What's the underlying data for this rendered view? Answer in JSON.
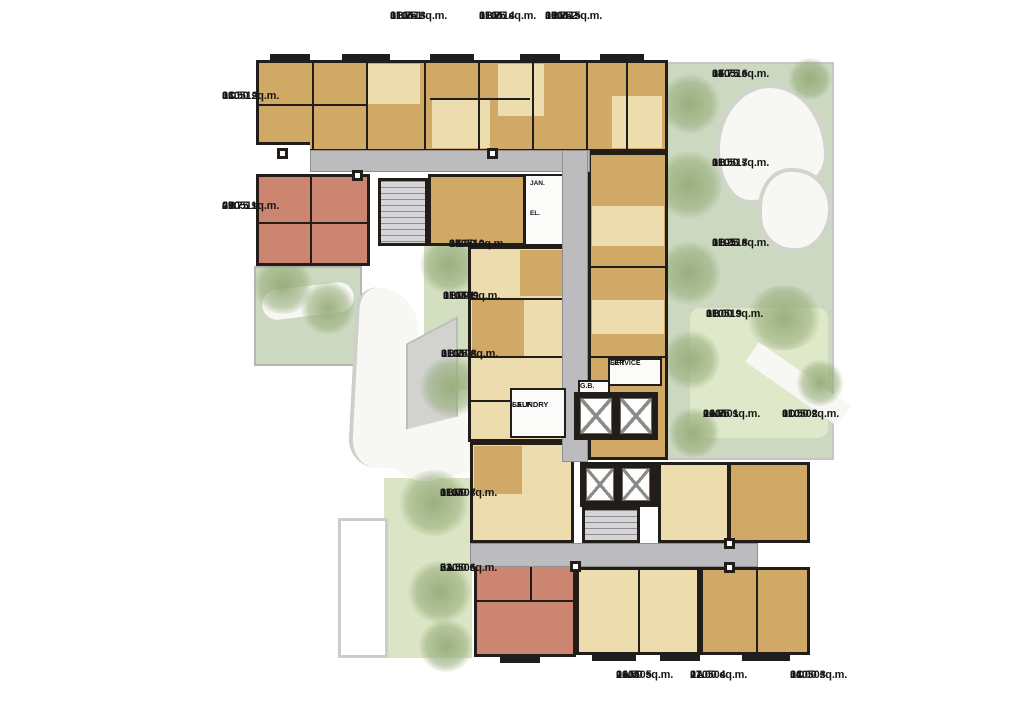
{
  "plan_type": "residential-floor-plan",
  "colors": {
    "unit_tan": "#d1a966",
    "unit_cream": "#ecdcae",
    "unit_salmon": "#cb8570",
    "corridor_gray": "#bcbcbf",
    "garden_green": "#ccd8c0",
    "wall_black": "#221d19",
    "background": "#ffffff"
  },
  "units": [
    {
      "id": "010513",
      "type": "1BM-1",
      "area": "31.75  sq.m."
    },
    {
      "id": "010514",
      "type": "1BM",
      "area": "31.75  sq.m."
    },
    {
      "id": "010515",
      "type": "1BM-2",
      "area": "30.75  sq.m."
    },
    {
      "id": "010512",
      "type": "1C",
      "area": "33.50  sq.m."
    },
    {
      "id": "010511",
      "type": "2B",
      "area": "49.75  sq.m."
    },
    {
      "id": "010516",
      "type": "1F",
      "area": "34.75  sq.m."
    },
    {
      "id": "010517",
      "type": "1B",
      "area": "31.50  sq.m."
    },
    {
      "id": "010518",
      "type": "1B-1",
      "area": "31.25  sq.m."
    },
    {
      "id": "010519",
      "type": "1B",
      "area": "31.00  sq.m."
    },
    {
      "id": "010510",
      "type": "1E",
      "area": "33.00  sq.m."
    },
    {
      "id": "010509",
      "type": "1BM-1",
      "area": "31.00  sq.m."
    },
    {
      "id": "010508",
      "type": "1BM",
      "area": "31.25  sq.m."
    },
    {
      "id": "010501",
      "type": "1AM",
      "area": "26.75  sq.m."
    },
    {
      "id": "010502",
      "type": "1D",
      "area": "31.50  sq.m."
    },
    {
      "id": "010507",
      "type": "1BM",
      "area": "31.00  sq.m."
    },
    {
      "id": "010506",
      "type": "2A",
      "area": "53.50  sq.m."
    },
    {
      "id": "010505",
      "type": "1AM",
      "area": "26.50  sq.m."
    },
    {
      "id": "010504",
      "type": "1A",
      "area": "27.00  sq.m."
    },
    {
      "id": "010503",
      "type": "1C",
      "area": "34.00  sq.m."
    }
  ],
  "core": {
    "self_line1": "SELF",
    "self_line2": "LAUNDRY",
    "service_line1": "SERVICE",
    "service_line2": "LIFT",
    "gb": "G.B.",
    "jan": "JAN.",
    "el": "EL."
  }
}
